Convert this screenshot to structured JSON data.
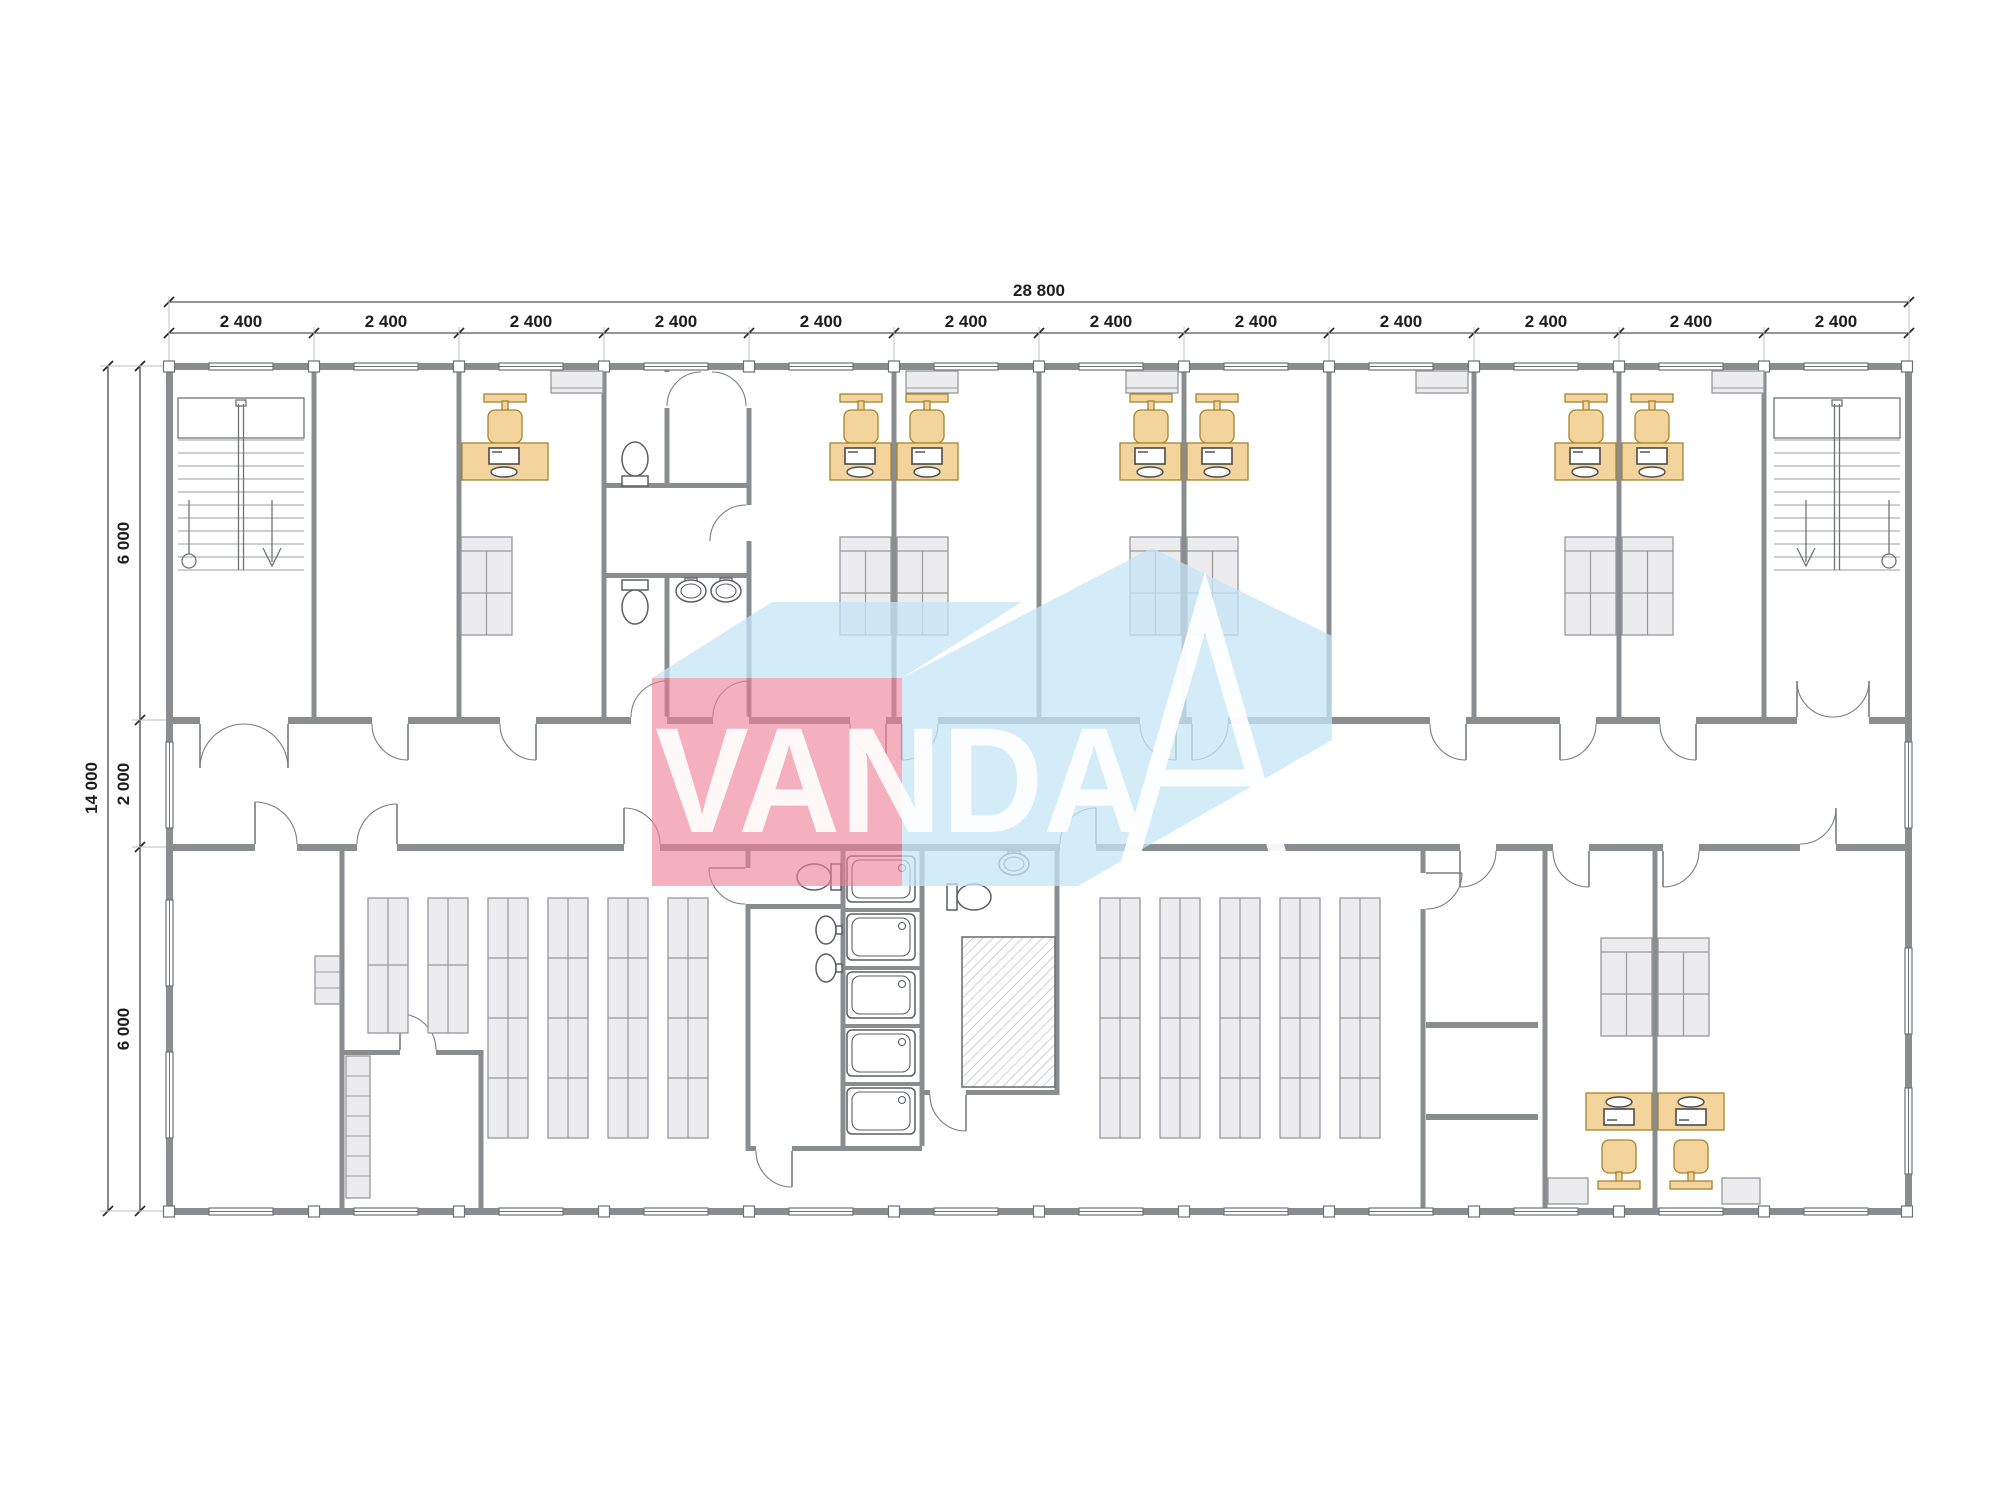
{
  "document": {
    "kind": "architectural floor plan drawing",
    "background": "#ffffff"
  },
  "dims": {
    "top_total": "28 800",
    "top_modules": [
      "2 400",
      "2 400",
      "2 400",
      "2 400",
      "2 400",
      "2 400",
      "2 400",
      "2 400",
      "2 400",
      "2 400",
      "2 400",
      "2 400"
    ],
    "left_total": "14 000",
    "left_sections": [
      "6 000",
      "2 000",
      "6 000"
    ]
  },
  "watermark": {
    "text": "VANDA"
  },
  "colors": {
    "wall": "#8a8d90",
    "furniture_yellow": "#f2d49c",
    "furniture_yellow_stroke": "#a6832e",
    "furniture_gray": "#ececee",
    "dim_text": "#1d1d1d",
    "watermark_pink": "#ee7f95",
    "watermark_blue": "#c5e4f6",
    "watermark_text": "#ffffff"
  }
}
